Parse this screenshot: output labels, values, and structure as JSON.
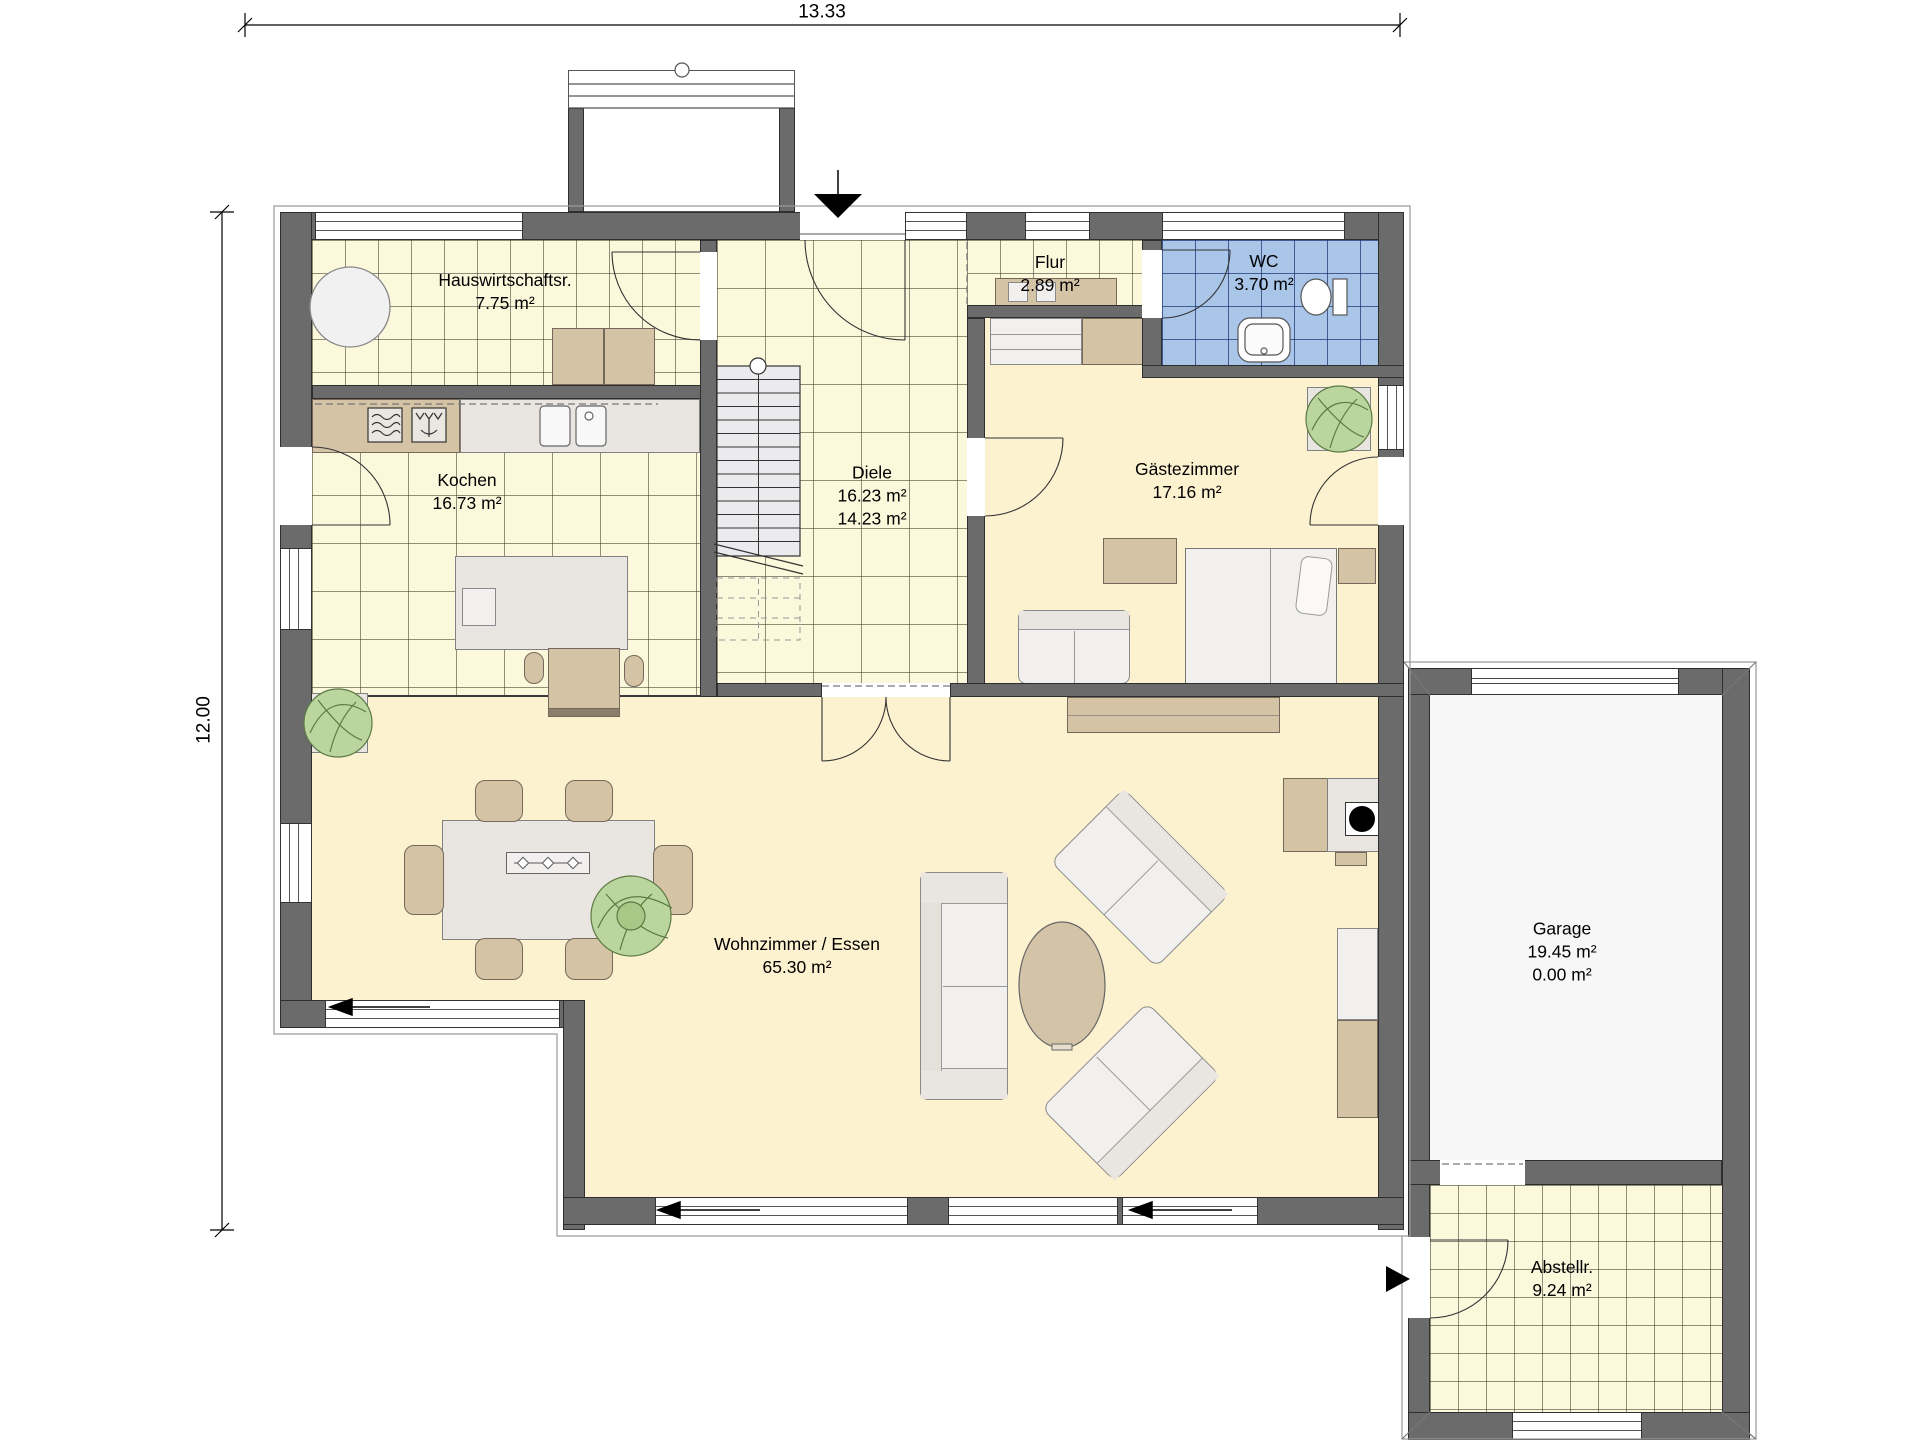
{
  "dimensions": {
    "width_label": "13.33",
    "height_label": "12.00"
  },
  "rooms": {
    "hauswirtschaftsraum": {
      "name": "Hauswirtschaftsr.",
      "area": "7.75 m²"
    },
    "flur": {
      "name": "Flur",
      "area": "2.89 m²"
    },
    "wc": {
      "name": "WC",
      "area": "3.70 m²"
    },
    "kochen": {
      "name": "Kochen",
      "area": "16.73 m²"
    },
    "diele": {
      "name": "Diele",
      "area": "16.23 m²",
      "area2": "14.23 m²"
    },
    "gaestezimmer": {
      "name": "Gästezimmer",
      "area": "17.16 m²"
    },
    "wohnzimmer": {
      "name": "Wohnzimmer / Essen",
      "area": "65.30 m²"
    },
    "garage": {
      "name": "Garage",
      "area": "19.45 m²",
      "area2": "0.00 m²"
    },
    "abstellraum": {
      "name": "Abstellr.",
      "area": "9.24 m²"
    }
  },
  "colors": {
    "wall": "#6b6b6b",
    "tile_floor": "#fbf8dc",
    "wc_floor": "#a9c6e9",
    "living_floor": "#fdf2d0",
    "garage_floor": "#f7f7f8",
    "furniture_tan": "#d5c3a6",
    "furniture_light": "#e9e6e1",
    "plant_green": "#bad69e"
  }
}
